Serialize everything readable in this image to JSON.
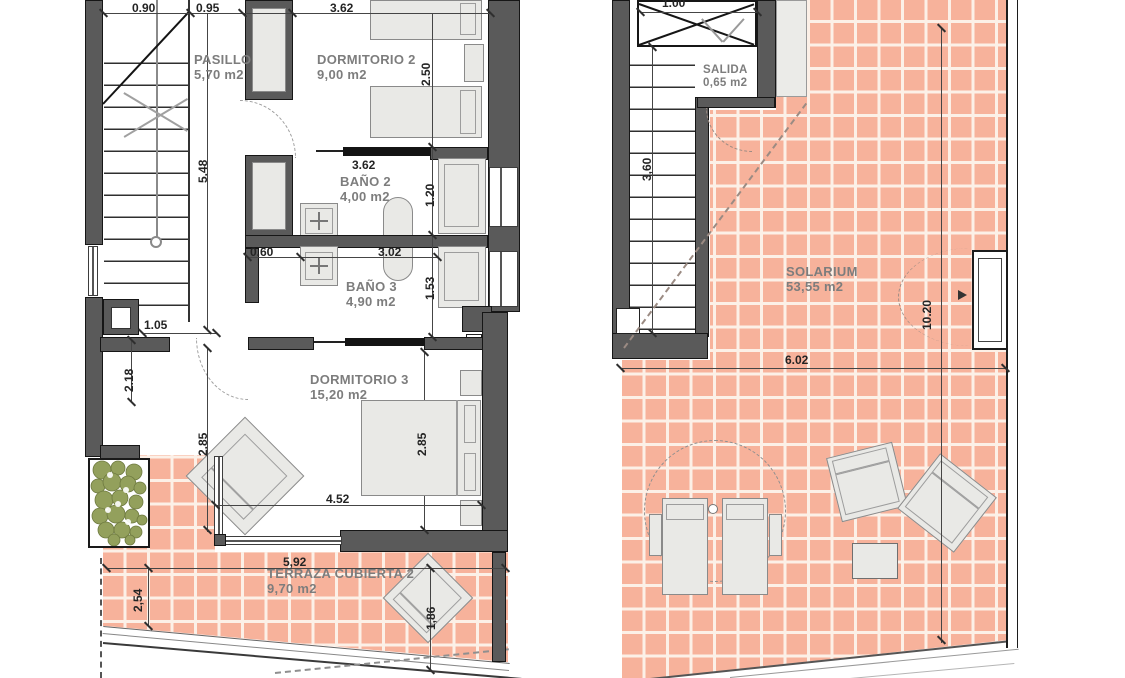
{
  "document": {
    "type": "architectural floor plans",
    "sheets": [
      "upper floor",
      "roof / solarium"
    ]
  },
  "colors": {
    "wall": "#5a5a5a",
    "wall_edge": "#161616",
    "tile": "#f7b29b",
    "grout": "#fcf0e7",
    "room_label": "#7d7d7d",
    "dim_text": "#242424",
    "plant": "#93a05c",
    "furniture_fill": "#e9e9e6",
    "furniture_border": "#8a8a8a",
    "dashed_roof": "#9b8b83"
  },
  "plan_left": {
    "rooms": {
      "pasillo": {
        "name": "PASILLO",
        "area": "5,70 m2"
      },
      "dormitorio2": {
        "name": "DORMITORIO 2",
        "area": "9,00 m2"
      },
      "bano2": {
        "name": "BAÑO 2",
        "area": "4,00 m2"
      },
      "bano3": {
        "name": "BAÑO 3",
        "area": "4,90 m2"
      },
      "dormitorio3": {
        "name": "DORMITORIO 3",
        "area": "15,20 m2"
      },
      "terraza": {
        "name": "TERRAZA CUBIERTA 2",
        "area": "9,70 m2"
      }
    },
    "dims": {
      "top1": "0.90",
      "top2": "0.95",
      "top3": "3.62",
      "stair_v": "5.48",
      "dorm2_v": "2.50",
      "bano2_w": "3.62",
      "bano2_v": "1.20",
      "bano3_left": "0.60",
      "bano3_w": "3.02",
      "bano3_v": "1.53",
      "closet_w": "1.05",
      "hall_v": "2.18",
      "dorm3_vl": "2.85",
      "dorm3_vr": "2.85",
      "dorm3_w": "4.52",
      "terraza_w": "5,92",
      "terraza_v": "2,54",
      "lounger": "1,86"
    }
  },
  "plan_right": {
    "rooms": {
      "salida": {
        "name": "SALIDA",
        "area": "0,65 m2"
      },
      "solarium": {
        "name": "SOLARIUM",
        "area": "53,55 m2"
      }
    },
    "dims": {
      "stair_top": "1.00",
      "stair_v": "3,60",
      "solarium_v": "10.20",
      "solarium_w": "6.02"
    }
  }
}
